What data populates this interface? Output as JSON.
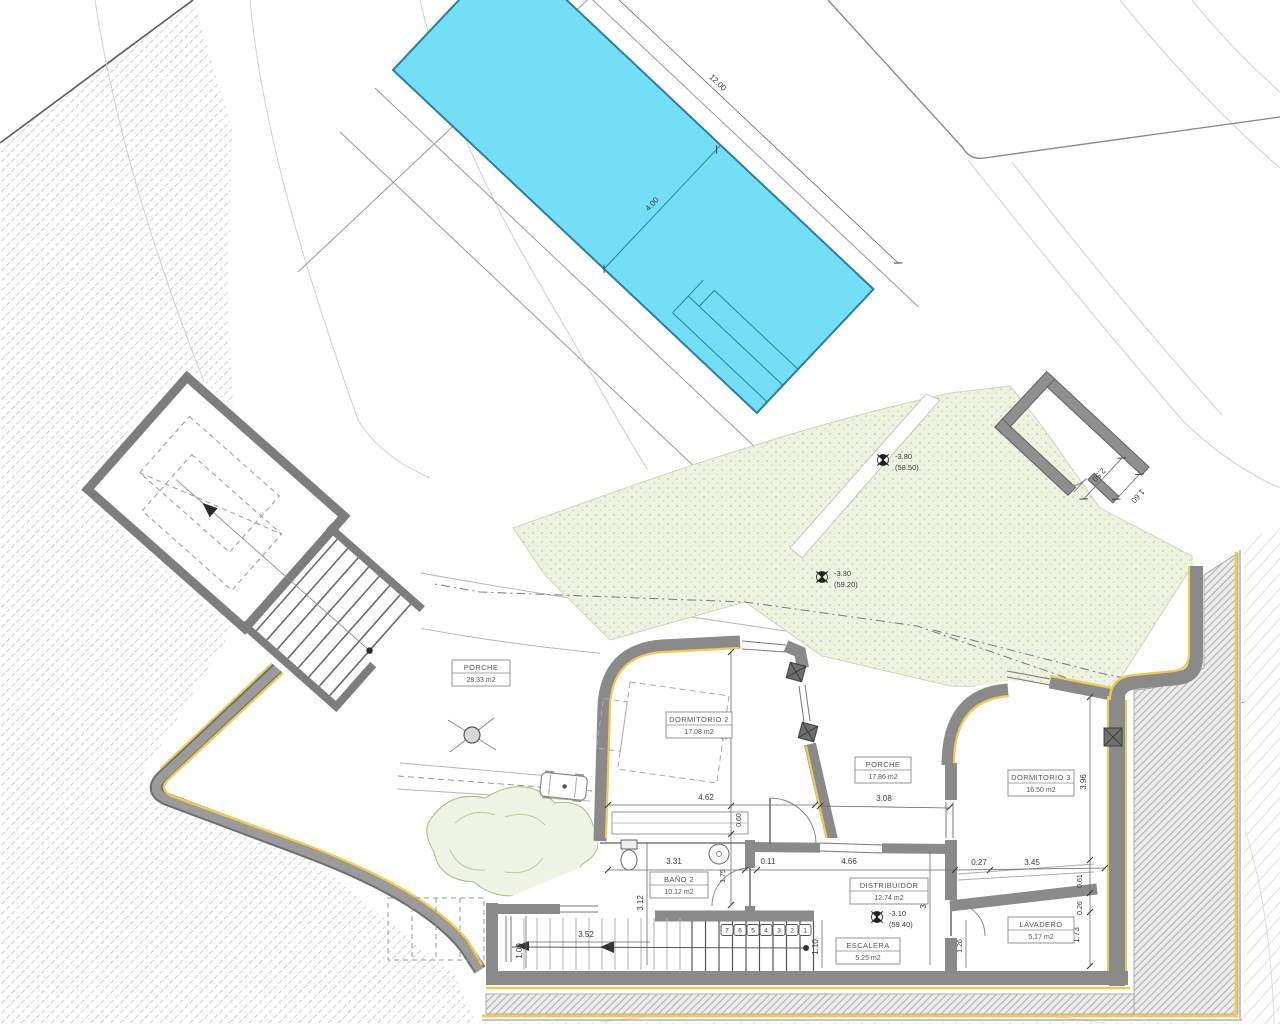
{
  "drawing": {
    "kind": "architectural site / floor plan",
    "rooms": [
      {
        "name": "PORCHE",
        "area": "28.33 m2"
      },
      {
        "name": "DORMITORIO 2",
        "area": "17.08 m2"
      },
      {
        "name": "PORCHE",
        "area": "17.86 m2"
      },
      {
        "name": "DORMITORIO 3",
        "area": "16.50 m2"
      },
      {
        "name": "BAÑO 2",
        "area": "10.12 m2"
      },
      {
        "name": "DISTRIBUIDOR",
        "area": "12.74 m2"
      },
      {
        "name": "ESCALERA",
        "area": "5.25 m2"
      },
      {
        "name": "LAVADERO",
        "area": "5,17 m2"
      }
    ],
    "levels": [
      {
        "value": "-3.80",
        "datum": "(58.50)"
      },
      {
        "value": "-3.30",
        "datum": "(59.20)"
      },
      {
        "value": "-3.10",
        "datum": "(59.40)"
      }
    ],
    "dimensions": {
      "pool_length": "12.00",
      "pool_width": "4.00",
      "annex_width": "2.50",
      "annex_opening": "1.60",
      "dorm2_height": "3.53",
      "dorm2_width": "4.62",
      "dorm2_sill": "0.60",
      "porche2_width": "3.08",
      "dorm3_height": "3.96",
      "bano2_width": "3.31",
      "wall_jog": "0.11",
      "distribuidor_width": "4.66",
      "lavadero_jog": "0.27",
      "lavadero_width": "3.45",
      "lavadero_step": "0.61",
      "bano2_door_depth": "1.75",
      "bano2_height": "3.12",
      "distribuidor_height": "3.13",
      "lavadero_ledge": "0.26",
      "lavadero_height": "1.73",
      "lavadero_door": "1.26",
      "stair_width": "1.10",
      "entry_width": "3.52",
      "entry_depth": "1.09"
    },
    "stairs": {
      "steps": [
        "7",
        "6",
        "5",
        "4",
        "3",
        "2",
        "1"
      ]
    },
    "colors": {
      "pool_fill": "#73DFF7",
      "pool_edge": "#2A7F9E",
      "wall_gray": "#8A8A8A",
      "accent_yellow": "#EFCB55",
      "terrain_green": "#EDF2E1",
      "hatch_gray": "#C9C9C9",
      "dim_color": "#3A3A3A"
    }
  }
}
